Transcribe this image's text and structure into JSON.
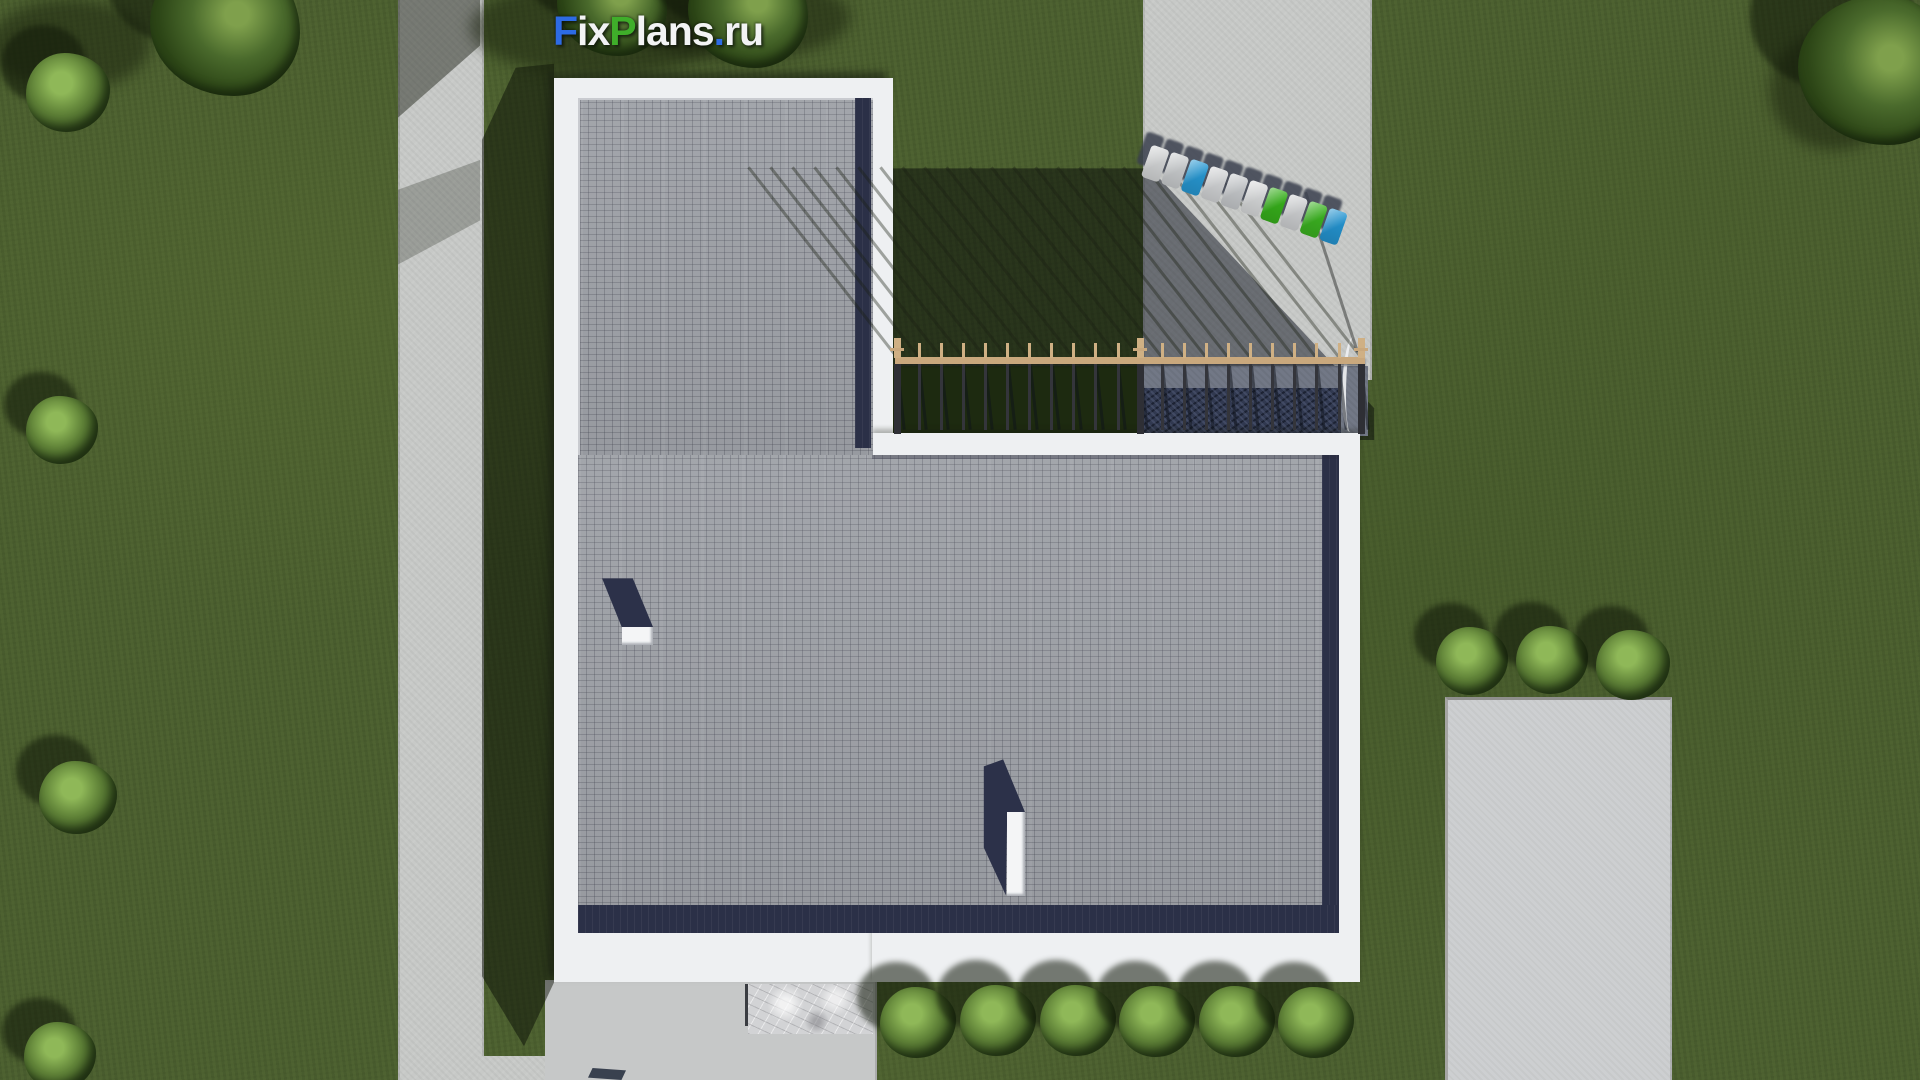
{
  "logo": {
    "text": "FixPlans.ru",
    "parts": [
      {
        "text": "F",
        "color": "#2d6be4"
      },
      {
        "text": "ix",
        "color": "#f2f3f4"
      },
      {
        "text": "P",
        "color": "#3fae2a"
      },
      {
        "text": "lans",
        "color": "#f2f3f4"
      },
      {
        "text": ".",
        "color": "#2d6be4"
      },
      {
        "text": "ru",
        "color": "#f2f3f4"
      }
    ]
  },
  "palette": {
    "grass": "#4c6030",
    "grass_shadow": "#273617",
    "concrete": "#c7c9c7",
    "concrete_shadow": "#727886",
    "roof_paver": "#9da0a6",
    "parapet_white": "#eef0f2",
    "inner_shadow_navy": "#2b3047",
    "fence_wood": "#c9a87d",
    "fence_post": "#34353b",
    "hedge_dark": "#313950"
  },
  "scene": {
    "description_labels": {
      "building": "L-shaped flat roof house with white parapet and gray paver roof",
      "view": "top-down aerial render"
    },
    "fence": {
      "x0": 897,
      "spacing": 22.1,
      "post_count": 22,
      "main_post_indices": [
        0,
        11,
        21
      ],
      "shadow_length": 242,
      "shadow_angle": -38
    },
    "parking": {
      "cars": [
        {
          "color": "#e8eaeb"
        },
        {
          "color": "#dde0e2"
        },
        {
          "color": "#2ba6e6"
        },
        {
          "color": "#e6e8ea"
        },
        {
          "color": "#d9dcdf"
        },
        {
          "color": "#eceeef"
        },
        {
          "color": "#3cc01e"
        },
        {
          "color": "#e2e4e6"
        },
        {
          "color": "#41c324"
        },
        {
          "color": "#28a2e4"
        }
      ],
      "car_step": 21
    },
    "vegetation": {
      "items": [
        {
          "cx": 68,
          "cy": 95,
          "d": 84,
          "tone": "light"
        },
        {
          "cx": 62,
          "cy": 432,
          "d": 72,
          "tone": "light"
        },
        {
          "cx": 78,
          "cy": 800,
          "d": 78,
          "tone": "light"
        },
        {
          "cx": 60,
          "cy": 1058,
          "d": 72,
          "tone": "light"
        },
        {
          "cx": 225,
          "cy": 30,
          "d": 150,
          "tone": "dark"
        },
        {
          "cx": 612,
          "cy": 8,
          "d": 110,
          "tone": "dark"
        },
        {
          "cx": 748,
          "cy": 15,
          "d": 120,
          "tone": "dark"
        },
        {
          "cx": 1878,
          "cy": 75,
          "d": 160,
          "tone": "dark"
        },
        {
          "cx": 918,
          "cy": 1025,
          "d": 76,
          "tone": "light"
        },
        {
          "cx": 998,
          "cy": 1023,
          "d": 76,
          "tone": "light"
        },
        {
          "cx": 1078,
          "cy": 1023,
          "d": 76,
          "tone": "light"
        },
        {
          "cx": 1157,
          "cy": 1024,
          "d": 76,
          "tone": "light"
        },
        {
          "cx": 1237,
          "cy": 1024,
          "d": 76,
          "tone": "light"
        },
        {
          "cx": 1316,
          "cy": 1025,
          "d": 76,
          "tone": "light"
        },
        {
          "cx": 1472,
          "cy": 663,
          "d": 72,
          "tone": "light"
        },
        {
          "cx": 1552,
          "cy": 662,
          "d": 72,
          "tone": "light"
        },
        {
          "cx": 1633,
          "cy": 667,
          "d": 74,
          "tone": "light"
        }
      ]
    }
  }
}
